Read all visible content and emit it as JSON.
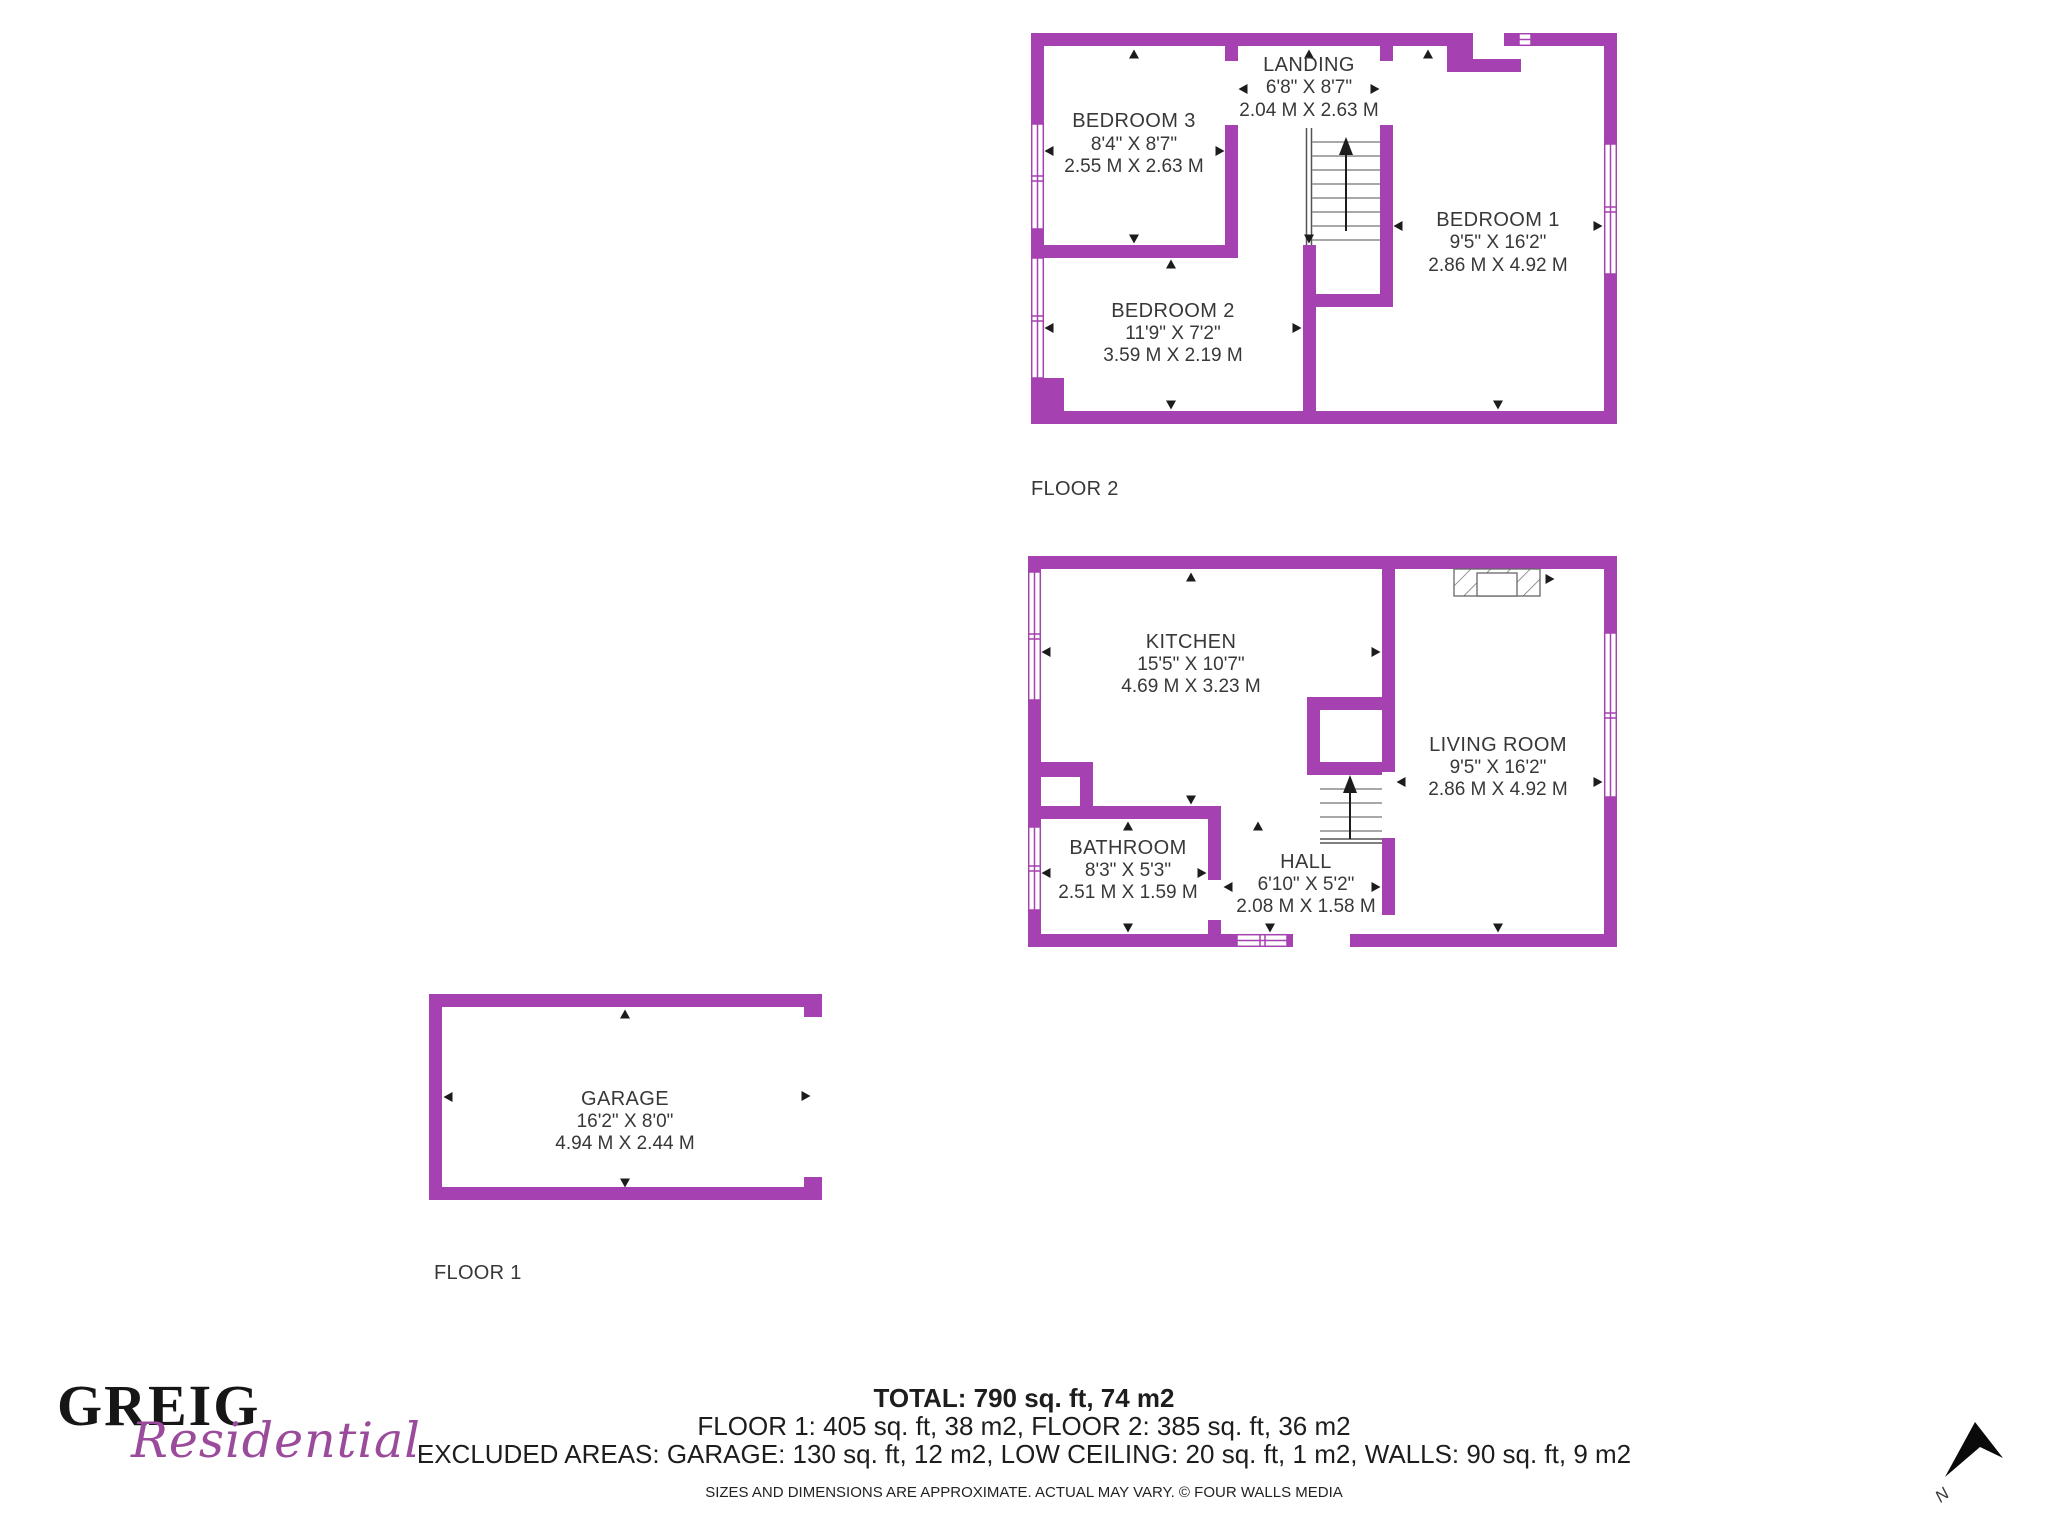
{
  "page": {
    "background": "#ffffff"
  },
  "colors": {
    "wall_purple": "#A641B1",
    "label_text": "#383838",
    "logo_black": "#161616",
    "logo_purple": "#9A4B9B",
    "stair_tread_gray": "#8c8c8c",
    "arrow_black": "#1c1c1c"
  },
  "floor2": {
    "label": "FLOOR 2",
    "rooms": [
      {
        "name": "BEDROOM 3",
        "imperial": "8'4\" X 8'7\"",
        "metric": "2.55 M X 2.63 M"
      },
      {
        "name": "LANDING",
        "imperial": "6'8\" X 8'7\"",
        "metric": "2.04 M X 2.63 M"
      },
      {
        "name": "BEDROOM 1",
        "imperial": "9'5\" X 16'2\"",
        "metric": "2.86 M X 4.92 M"
      },
      {
        "name": "BEDROOM 2",
        "imperial": "11'9\" X 7'2\"",
        "metric": "3.59 M X 2.19 M"
      }
    ]
  },
  "floor1": {
    "label": "FLOOR 1",
    "rooms": [
      {
        "name": "KITCHEN",
        "imperial": "15'5\" X 10'7\"",
        "metric": "4.69 M X 3.23 M"
      },
      {
        "name": "LIVING ROOM",
        "imperial": "9'5\" X 16'2\"",
        "metric": "2.86 M X 4.92 M"
      },
      {
        "name": "BATHROOM",
        "imperial": "8'3\" X 5'3\"",
        "metric": "2.51 M X 1.59 M"
      },
      {
        "name": "HALL",
        "imperial": "6'10\" X 5'2\"",
        "metric": "2.08 M X 1.58 M"
      }
    ]
  },
  "garage": {
    "name": "GARAGE",
    "imperial": "16'2\" X 8'0\"",
    "metric": "4.94 M X 2.44 M"
  },
  "logo": {
    "primary": "GREIG",
    "secondary": "Residential"
  },
  "summary": {
    "total": "TOTAL: 790 sq. ft, 74 m2",
    "floors": "FLOOR 1: 405 sq. ft, 38 m2, FLOOR 2: 385 sq. ft, 36 m2",
    "excluded": "EXCLUDED AREAS: GARAGE: 130 sq. ft, 12 m2, LOW CEILING: 20 sq. ft, 1 m2, WALLS: 90 sq. ft, 9 m2",
    "disclaimer": "SIZES AND DIMENSIONS ARE APPROXIMATE. ACTUAL MAY VARY. © FOUR WALLS MEDIA"
  },
  "compass": {
    "label": "N"
  }
}
